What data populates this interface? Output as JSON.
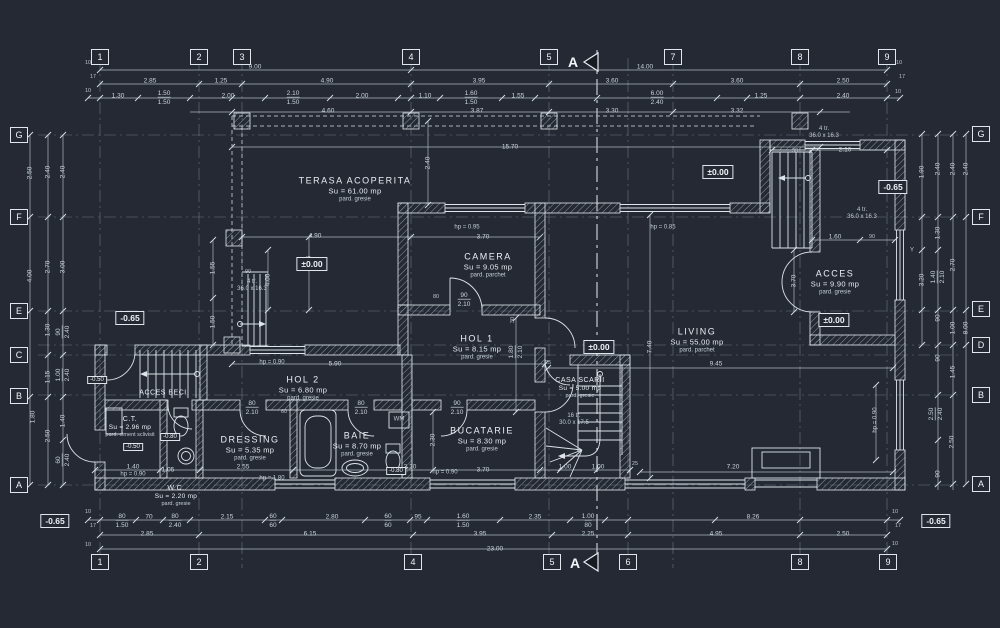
{
  "drawing": {
    "background": "#242933",
    "line_color": "#e8edf2",
    "dim_color": "#ccd4dc",
    "type": "floor-plan"
  },
  "section": {
    "label": "A"
  },
  "grid_bubbles": [
    {
      "label": "1",
      "x": 100,
      "y": 57
    },
    {
      "label": "2",
      "x": 199,
      "y": 57
    },
    {
      "label": "3",
      "x": 242,
      "y": 57
    },
    {
      "label": "4",
      "x": 411,
      "y": 57
    },
    {
      "label": "5",
      "x": 549,
      "y": 57
    },
    {
      "label": "7",
      "x": 673,
      "y": 57
    },
    {
      "label": "8",
      "x": 800,
      "y": 57
    },
    {
      "label": "9",
      "x": 887,
      "y": 57
    },
    {
      "label": "1",
      "x": 100,
      "y": 562
    },
    {
      "label": "2",
      "x": 199,
      "y": 562
    },
    {
      "label": "4",
      "x": 413,
      "y": 562
    },
    {
      "label": "5",
      "x": 552,
      "y": 562
    },
    {
      "label": "6",
      "x": 628,
      "y": 562
    },
    {
      "label": "8",
      "x": 800,
      "y": 562
    },
    {
      "label": "9",
      "x": 888,
      "y": 562
    },
    {
      "label": "G",
      "x": 19,
      "y": 135
    },
    {
      "label": "F",
      "x": 19,
      "y": 217
    },
    {
      "label": "E",
      "x": 19,
      "y": 311
    },
    {
      "label": "C",
      "x": 19,
      "y": 355
    },
    {
      "label": "B",
      "x": 19,
      "y": 396
    },
    {
      "label": "A",
      "x": 19,
      "y": 485
    },
    {
      "label": "G",
      "x": 981,
      "y": 134
    },
    {
      "label": "F",
      "x": 981,
      "y": 217
    },
    {
      "label": "E",
      "x": 981,
      "y": 309
    },
    {
      "label": "D",
      "x": 981,
      "y": 345
    },
    {
      "label": "B",
      "x": 981,
      "y": 395
    },
    {
      "label": "A",
      "x": 981,
      "y": 484
    }
  ],
  "rooms": [
    {
      "name": "TERASA ACOPERITA",
      "area": "Su = 61.00 mp",
      "floor": "pard. gresie",
      "x": 355,
      "y": 189
    },
    {
      "name": "CAMERA",
      "area": "Su = 9.05 mp",
      "floor": "pard. parchet",
      "x": 488,
      "y": 265
    },
    {
      "name": "HOL 1",
      "area": "Su = 8.15 mp",
      "floor": "pard. gresie",
      "x": 477,
      "y": 347
    },
    {
      "name": "LIVING",
      "area": "Su = 55.00 mp",
      "floor": "pard. parchet",
      "x": 697,
      "y": 340
    },
    {
      "name": "ACCES",
      "area": "Su = 9.90 mp",
      "floor": "pard. gresie",
      "x": 835,
      "y": 282
    },
    {
      "name": "HOL 2",
      "area": "Su = 6.80 mp",
      "floor": "pard. gresie",
      "x": 303,
      "y": 388
    },
    {
      "name": "DRESSING",
      "area": "Su = 5.35 mp",
      "floor": "pard. gresie",
      "x": 250,
      "y": 448
    },
    {
      "name": "BAIE",
      "area": "Su = 8.70 mp",
      "floor": "pard. gresie",
      "x": 357,
      "y": 444
    },
    {
      "name": "BUCATARIE",
      "area": "Su = 8.30 mp",
      "floor": "pard. gresie",
      "x": 482,
      "y": 439
    },
    {
      "name": "CASA SCARII",
      "area": "Su = 5.00 mp",
      "floor": "pard. gresie",
      "x": 580,
      "y": 388,
      "cls": "sm"
    },
    {
      "name": "C.T.",
      "area": "Su = 2.96 mp",
      "floor": "pard. ciment sclivisit",
      "x": 130,
      "y": 427,
      "cls": "sm"
    },
    {
      "name": "W.C.",
      "area": "Su = 2.20 mp",
      "floor": "pard. gresie",
      "x": 176,
      "y": 496,
      "cls": "sm"
    },
    {
      "name": "ACCES BECI",
      "x": 163,
      "y": 393,
      "cls": "sm"
    }
  ],
  "levels": [
    {
      "t": "±0.00",
      "x": 312,
      "y": 264
    },
    {
      "t": "±0.00",
      "x": 718,
      "y": 172
    },
    {
      "t": "±0.00",
      "x": 599,
      "y": 347
    },
    {
      "t": "±0.00",
      "x": 834,
      "y": 320
    },
    {
      "t": "-0.65",
      "x": 130,
      "y": 318
    },
    {
      "t": "-0.65",
      "x": 893,
      "y": 187
    },
    {
      "t": "-0.65",
      "x": 55,
      "y": 521
    },
    {
      "t": "-0.65",
      "x": 936,
      "y": 521
    },
    {
      "t": "-0.50",
      "x": 97,
      "y": 380,
      "cls": "sm"
    },
    {
      "t": "-0.50",
      "x": 133,
      "y": 447,
      "cls": "sm"
    },
    {
      "t": "-0.80",
      "x": 170,
      "y": 437,
      "cls": "sm"
    },
    {
      "t": "-0.80",
      "x": 396,
      "y": 471,
      "cls": "sm"
    }
  ],
  "notes": [
    {
      "t": "4 tr.",
      "t2": "36.0 x 16.3",
      "x": 252,
      "y": 286
    },
    {
      "t": "4 tr.",
      "t2": "36.0 x 16.3",
      "x": 824,
      "y": 133
    },
    {
      "t": "4 tr.",
      "t2": "36.0 x 16.3",
      "x": 862,
      "y": 214
    },
    {
      "t": "16 tr.",
      "t2": "30.0 x 17.5",
      "x": 574,
      "y": 420
    },
    {
      "t": "WM",
      "x": 399,
      "y": 420
    },
    {
      "t": "hp = 0.95",
      "x": 467,
      "y": 228
    },
    {
      "t": "hp = 0.85",
      "x": 663,
      "y": 228
    },
    {
      "t": "hp = 0.90",
      "x": 272,
      "y": 363
    },
    {
      "t": "hp = 0.90",
      "x": 445,
      "y": 473
    },
    {
      "t": "hp = 1.80",
      "x": 272,
      "y": 479
    },
    {
      "t": "hp = 0.90",
      "x": 133,
      "y": 475
    },
    {
      "t": "hp = 0.90",
      "x": 876,
      "y": 420,
      "r": -90
    },
    {
      "t": "Y",
      "x": 912,
      "y": 251
    }
  ],
  "dims": [
    {
      "t": "9.00",
      "x": 255,
      "y": 67
    },
    {
      "t": "14.00",
      "x": 645,
      "y": 67
    },
    {
      "t": "2.85",
      "x": 150,
      "y": 81
    },
    {
      "t": "1.25",
      "x": 221,
      "y": 81
    },
    {
      "t": "4.90",
      "x": 327,
      "y": 81
    },
    {
      "t": "3.95",
      "x": 479,
      "y": 81
    },
    {
      "t": "3.60",
      "x": 612,
      "y": 81
    },
    {
      "t": "3.60",
      "x": 737,
      "y": 81
    },
    {
      "t": "2.50",
      "x": 843,
      "y": 81
    },
    {
      "t": "1.30",
      "x": 118,
      "y": 96
    },
    {
      "t": "1.50",
      "t2": "1.50",
      "x": 164,
      "y": 98
    },
    {
      "t": "2.00",
      "x": 228,
      "y": 96
    },
    {
      "t": "2.10",
      "t2": "1.50",
      "x": 293,
      "y": 98
    },
    {
      "t": "2.00",
      "x": 362,
      "y": 96
    },
    {
      "t": "1.10",
      "x": 425,
      "y": 96
    },
    {
      "t": "1.60",
      "t2": "1.50",
      "x": 471,
      "y": 98
    },
    {
      "t": "1.55",
      "x": 518,
      "y": 96
    },
    {
      "t": "6.00",
      "t2": "2.40",
      "x": 657,
      "y": 98
    },
    {
      "t": "1.25",
      "x": 761,
      "y": 96
    },
    {
      "t": "2.40",
      "x": 843,
      "y": 96
    },
    {
      "t": "4.60",
      "x": 328,
      "y": 111
    },
    {
      "t": "3.87",
      "x": 477,
      "y": 111
    },
    {
      "t": "3.30",
      "x": 612,
      "y": 111
    },
    {
      "t": "3.32",
      "x": 737,
      "y": 111
    },
    {
      "t": "15.70",
      "x": 510,
      "y": 147
    },
    {
      "t": "10",
      "x": 88,
      "y": 63,
      "cls": "tk"
    },
    {
      "t": "17",
      "x": 93,
      "y": 77,
      "cls": "tk"
    },
    {
      "t": "10",
      "x": 88,
      "y": 91,
      "cls": "tk"
    },
    {
      "t": "10",
      "x": 899,
      "y": 63,
      "cls": "tk"
    },
    {
      "t": "17",
      "x": 902,
      "y": 77,
      "cls": "tk"
    },
    {
      "t": "10",
      "x": 898,
      "y": 92,
      "cls": "tk"
    },
    {
      "t": "80",
      "t2": "1.50",
      "x": 122,
      "y": 521
    },
    {
      "t": "70",
      "x": 149,
      "y": 517
    },
    {
      "t": "80",
      "t2": "2.40",
      "x": 175,
      "y": 521
    },
    {
      "t": "2.15",
      "x": 227,
      "y": 517
    },
    {
      "t": "60",
      "t2": "60",
      "x": 273,
      "y": 521
    },
    {
      "t": "2.80",
      "x": 332,
      "y": 517
    },
    {
      "t": "60",
      "t2": "60",
      "x": 388,
      "y": 521
    },
    {
      "t": "95",
      "x": 418,
      "y": 517
    },
    {
      "t": "1.60",
      "t2": "1.50",
      "x": 463,
      "y": 521
    },
    {
      "t": "2.35",
      "x": 535,
      "y": 517
    },
    {
      "t": "1.00",
      "t2": "80",
      "x": 588,
      "y": 521
    },
    {
      "t": "8.26",
      "x": 753,
      "y": 517
    },
    {
      "t": "2.85",
      "x": 147,
      "y": 534
    },
    {
      "t": "6.15",
      "x": 310,
      "y": 534
    },
    {
      "t": "3.95",
      "x": 480,
      "y": 534
    },
    {
      "t": "2.25",
      "x": 588,
      "y": 534
    },
    {
      "t": "4.95",
      "x": 716,
      "y": 534
    },
    {
      "t": "2.50",
      "x": 843,
      "y": 534
    },
    {
      "t": "23.00",
      "x": 495,
      "y": 549
    },
    {
      "t": "10",
      "x": 88,
      "y": 512,
      "cls": "tk"
    },
    {
      "t": "17",
      "x": 93,
      "y": 526,
      "cls": "tk"
    },
    {
      "t": "10",
      "x": 88,
      "y": 545,
      "cls": "tk"
    },
    {
      "t": "10",
      "x": 895,
      "y": 512,
      "cls": "tk"
    },
    {
      "t": "17",
      "x": 898,
      "y": 526,
      "cls": "tk"
    },
    {
      "t": "10",
      "x": 895,
      "y": 544,
      "cls": "tk"
    },
    {
      "t": "2.50",
      "x": 30,
      "y": 173,
      "r": -90
    },
    {
      "t": "4.00",
      "x": 30,
      "y": 276,
      "r": -90
    },
    {
      "t": "1.80",
      "x": 33,
      "y": 417,
      "r": -90
    },
    {
      "t": "2.40",
      "x": 48,
      "y": 172,
      "r": -90
    },
    {
      "t": "2.70",
      "x": 48,
      "y": 267,
      "r": -90
    },
    {
      "t": "1.30",
      "x": 48,
      "y": 330,
      "r": -90
    },
    {
      "t": "1.15",
      "x": 48,
      "y": 377,
      "r": -90
    },
    {
      "t": "2.50",
      "x": 48,
      "y": 436,
      "r": -90
    },
    {
      "t": "2.40",
      "x": 63,
      "y": 172,
      "r": -90
    },
    {
      "t": "3.00",
      "x": 63,
      "y": 267,
      "r": -90
    },
    {
      "t": "90",
      "t2": "2.40",
      "x": 63,
      "y": 332,
      "r": -90
    },
    {
      "t": "1.00",
      "t2": "2.40",
      "x": 63,
      "y": 375,
      "r": -90
    },
    {
      "t": "1.40",
      "x": 63,
      "y": 421,
      "r": -90
    },
    {
      "t": "60",
      "t2": "2.40",
      "x": 63,
      "y": 460,
      "r": -90
    },
    {
      "t": "1.90",
      "x": 922,
      "y": 172,
      "r": -90
    },
    {
      "t": "2.40",
      "x": 938,
      "y": 169,
      "r": -90
    },
    {
      "t": "2.40",
      "x": 953,
      "y": 169,
      "r": -90
    },
    {
      "t": "2.40",
      "x": 966,
      "y": 169,
      "r": -90
    },
    {
      "t": "1.30",
      "x": 938,
      "y": 233,
      "r": -90
    },
    {
      "t": "2.70",
      "x": 953,
      "y": 265,
      "r": -90
    },
    {
      "t": "3.20",
      "x": 922,
      "y": 280,
      "r": -90
    },
    {
      "t": "1.40",
      "t2": "2.10",
      "x": 938,
      "y": 277,
      "r": -90
    },
    {
      "t": "90",
      "x": 938,
      "y": 318,
      "r": -90
    },
    {
      "t": "1.00",
      "x": 953,
      "y": 328,
      "r": -90
    },
    {
      "t": "8.00",
      "x": 966,
      "y": 328,
      "r": -90
    },
    {
      "t": "90",
      "x": 938,
      "y": 358,
      "r": -90
    },
    {
      "t": "1.45",
      "x": 953,
      "y": 372,
      "r": -90
    },
    {
      "t": "2.50",
      "t2": "2.40",
      "x": 936,
      "y": 414,
      "r": -90
    },
    {
      "t": "2.50",
      "x": 952,
      "y": 442,
      "r": -90
    },
    {
      "t": "90",
      "x": 938,
      "y": 474,
      "r": -90
    },
    {
      "t": "4.90",
      "x": 315,
      "y": 236
    },
    {
      "t": "3.70",
      "x": 483,
      "y": 237
    },
    {
      "t": "2.40",
      "x": 428,
      "y": 163,
      "r": -90
    },
    {
      "t": "2.45",
      "x": 309,
      "y": 262,
      "r": -90
    },
    {
      "t": "80",
      "x": 436,
      "y": 297,
      "cls": "tk"
    },
    {
      "t": "90",
      "t2": "2.10",
      "x": 464,
      "y": 300
    },
    {
      "t": "30",
      "x": 513,
      "y": 320,
      "r": -90,
      "cls": "tk"
    },
    {
      "t": "1.80",
      "t2": "2.10",
      "x": 516,
      "y": 352,
      "r": -90
    },
    {
      "t": "3.70",
      "x": 794,
      "y": 281,
      "r": -90
    },
    {
      "t": "7.40",
      "x": 650,
      "y": 347,
      "r": -90
    },
    {
      "t": "9.45",
      "x": 716,
      "y": 364
    },
    {
      "t": "7.20",
      "x": 733,
      "y": 467
    },
    {
      "t": "2.10",
      "x": 845,
      "y": 150
    },
    {
      "t": "90",
      "x": 795,
      "y": 151,
      "cls": "tk"
    },
    {
      "t": "1.60",
      "x": 835,
      "y": 237
    },
    {
      "t": "90",
      "x": 872,
      "y": 237,
      "cls": "tk"
    },
    {
      "t": "5.90",
      "x": 335,
      "y": 364
    },
    {
      "t": "2.55",
      "x": 243,
      "y": 467
    },
    {
      "t": "1.40",
      "x": 133,
      "y": 467
    },
    {
      "t": "1.05",
      "x": 168,
      "y": 470
    },
    {
      "t": "3.20",
      "x": 410,
      "y": 467
    },
    {
      "t": "3.70",
      "x": 483,
      "y": 470
    },
    {
      "t": "2.30",
      "x": 433,
      "y": 440,
      "r": -90
    },
    {
      "t": "1.00",
      "x": 565,
      "y": 467
    },
    {
      "t": "1.00",
      "x": 598,
      "y": 467
    },
    {
      "t": "25",
      "x": 635,
      "y": 464,
      "cls": "tk"
    },
    {
      "t": "25",
      "x": 548,
      "y": 363,
      "cls": "tk"
    },
    {
      "t": "80",
      "t2": "2.10",
      "x": 252,
      "y": 408
    },
    {
      "t": "60",
      "x": 284,
      "y": 412,
      "cls": "tk"
    },
    {
      "t": "80",
      "t2": "2.10",
      "x": 361,
      "y": 408
    },
    {
      "t": "90",
      "t2": "2.10",
      "x": 457,
      "y": 408
    },
    {
      "t": "4.00",
      "x": 268,
      "y": 280,
      "r": -90
    },
    {
      "t": "1.55",
      "x": 213,
      "y": 268,
      "r": -90
    },
    {
      "t": "1.50",
      "x": 213,
      "y": 322,
      "r": -90
    },
    {
      "t": "90",
      "x": 248,
      "y": 272,
      "cls": "tk"
    }
  ]
}
